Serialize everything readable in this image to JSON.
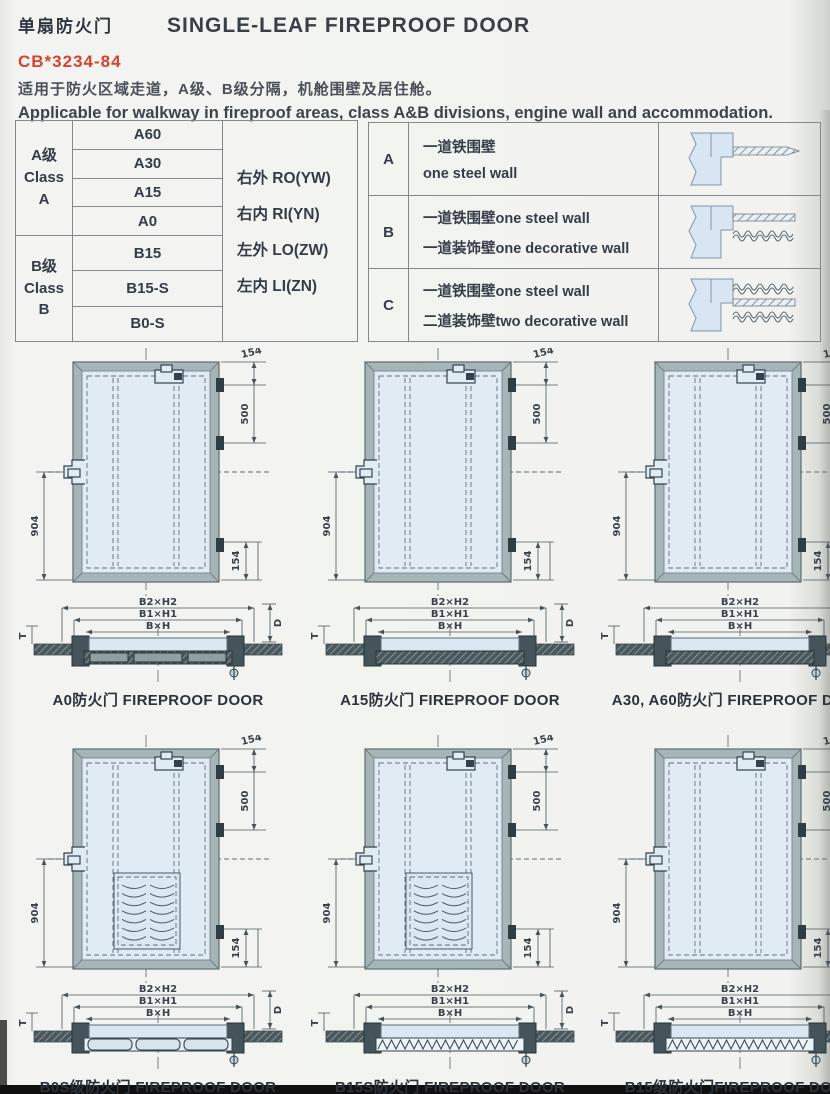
{
  "header": {
    "title_cn": "单扇防火门",
    "title_en": "SINGLE-LEAF FIREPROOF DOOR",
    "standard": "CB*3234-84",
    "desc_cn": "适用于防火区域走道，A级、B级分隔，机舱围壁及居住舱。",
    "desc_en": "Applicable for walkway in fireproof areas, class A&B divisions, engine wall and accommodation."
  },
  "class_table": {
    "class_a": {
      "label": "A级\nClass\nA",
      "ratings": [
        "A60",
        "A30",
        "A15",
        "A0"
      ]
    },
    "class_b": {
      "label": "B级\nClass\nB",
      "ratings": [
        "B15",
        "B15-S",
        "B0-S"
      ]
    },
    "codes": [
      "右外 RO(YW)",
      "右内 RI(YN)",
      "左外 LO(ZW)",
      "左内 LI(ZN)"
    ]
  },
  "wall_table": {
    "rows": [
      {
        "key": "A",
        "lines": [
          "一道铁围壁",
          "one steel wall"
        ],
        "diagram": "one"
      },
      {
        "key": "B",
        "lines": [
          "一道铁围壁one steel wall",
          "一道装饰壁one decorative wall"
        ],
        "diagram": "two"
      },
      {
        "key": "C",
        "lines": [
          "一道铁围壁one steel wall",
          "二道装饰壁two decorative wall"
        ],
        "diagram": "three"
      }
    ]
  },
  "dims": {
    "top": "154",
    "right": "500",
    "left": "904",
    "bottom": "154"
  },
  "section_labels": {
    "outer": "B2×H2",
    "mid": "B1×H1",
    "inner": "B×H",
    "depth": "D",
    "thick": "T"
  },
  "doors": [
    {
      "caption_cn": "A0防火门",
      "caption_en": "FIREPROOF DOOR",
      "sep": " ",
      "louver": false,
      "section": "segmented"
    },
    {
      "caption_cn": "A15防火门",
      "caption_en": "FIREPROOF DOOR",
      "sep": " ",
      "louver": false,
      "section": "hatch"
    },
    {
      "caption_cn": "A30, A60防火门",
      "caption_en": "FIREPROOF DOOR",
      "sep": " ",
      "louver": false,
      "section": "hatch"
    },
    {
      "caption_cn": "B0S级防火门",
      "caption_en": "FIREPROOF DOOR",
      "sep": " ",
      "louver": true,
      "section": "pills"
    },
    {
      "caption_cn": "B15S防火门",
      "caption_en": "FIREPROOF DOOR",
      "sep": " ",
      "louver": true,
      "section": "zigzag"
    },
    {
      "caption_cn": "B15级防火门",
      "caption_en": "FIREPROOF DOOR",
      "sep": "",
      "louver": false,
      "section": "zigzag"
    }
  ],
  "colors": {
    "accent_red": "#d5422f",
    "door_panel_blue": "#e1ebf3",
    "frame_gray": "#a6b6b8",
    "line_dark": "#33424c"
  }
}
